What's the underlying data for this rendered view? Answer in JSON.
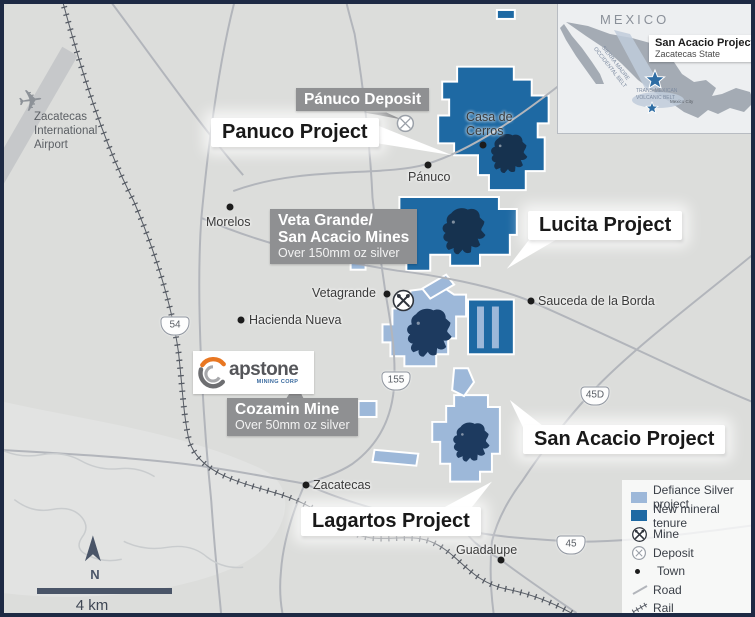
{
  "colors": {
    "defiance_project": "#9db8d9",
    "new_mineral_tenure": "#1e69a3",
    "lion_navy": "#1d3a5f",
    "info_label_bg": "#8f9092",
    "map_background": "#dcdddb",
    "frame_border": "#1e2a44",
    "capstone_orange": "#e87722",
    "capstone_gray": "#6d6e71"
  },
  "projects": {
    "panuco": {
      "label": "Panuco Project"
    },
    "lucita": {
      "label": "Lucita Project"
    },
    "san_acacio": {
      "label": "San Acacio Project"
    },
    "lagartos": {
      "label": "Lagartos Project"
    }
  },
  "info_labels": {
    "panuco_deposit": {
      "title": "Pánuco Deposit"
    },
    "veta_grande": {
      "line1": "Veta Grande/",
      "line2": "San Acacio Mines",
      "subtitle": "Over 150mm oz silver"
    },
    "cozamin": {
      "title": "Cozamin Mine",
      "subtitle": "Over 50mm oz silver"
    }
  },
  "towns": {
    "panuco": "Pánuco",
    "casa_de_cerros_l1": "Casa de",
    "casa_de_cerros_l2": "Cerros",
    "morelos": "Morelos",
    "hacienda_nueva": "Hacienda Nueva",
    "vetagrande": "Vetagrande",
    "sauceda": "Sauceda de la Borda",
    "zacatecas": "Zacatecas",
    "guadalupe": "Guadalupe"
  },
  "airport": {
    "line1": "Zacatecas",
    "line2": "International",
    "line3": "Airport"
  },
  "shields": {
    "s54": "54",
    "s155": "155",
    "s45d": "45D",
    "s45": "45"
  },
  "scalebar": {
    "label": "4 km"
  },
  "north": {
    "label": "N"
  },
  "capstone": {
    "wordmark": "apstone",
    "tagline": "MINING CORP"
  },
  "inset": {
    "country": "MEXICO",
    "callout_title": "San Acacio Project",
    "callout_subtitle": "Zacatecas State",
    "belt1": "SIERRA MADRE OCCIDENTAL BELT",
    "belt2_line1": "TRANS-MEXICAN",
    "belt2_line2": "VOLCANIC BELT",
    "city": "Mexico City"
  },
  "legend": {
    "items": [
      {
        "icon": "defiance-swatch",
        "label": "Defiance Silver project"
      },
      {
        "icon": "tenure-swatch",
        "label": "New mineral tenure"
      },
      {
        "icon": "mine-icon",
        "label": "Mine"
      },
      {
        "icon": "deposit-icon",
        "label": "Deposit"
      },
      {
        "icon": "town-dot",
        "label": "Town"
      },
      {
        "icon": "road-line",
        "label": "Road"
      },
      {
        "icon": "rail-line",
        "label": "Rail"
      }
    ]
  }
}
